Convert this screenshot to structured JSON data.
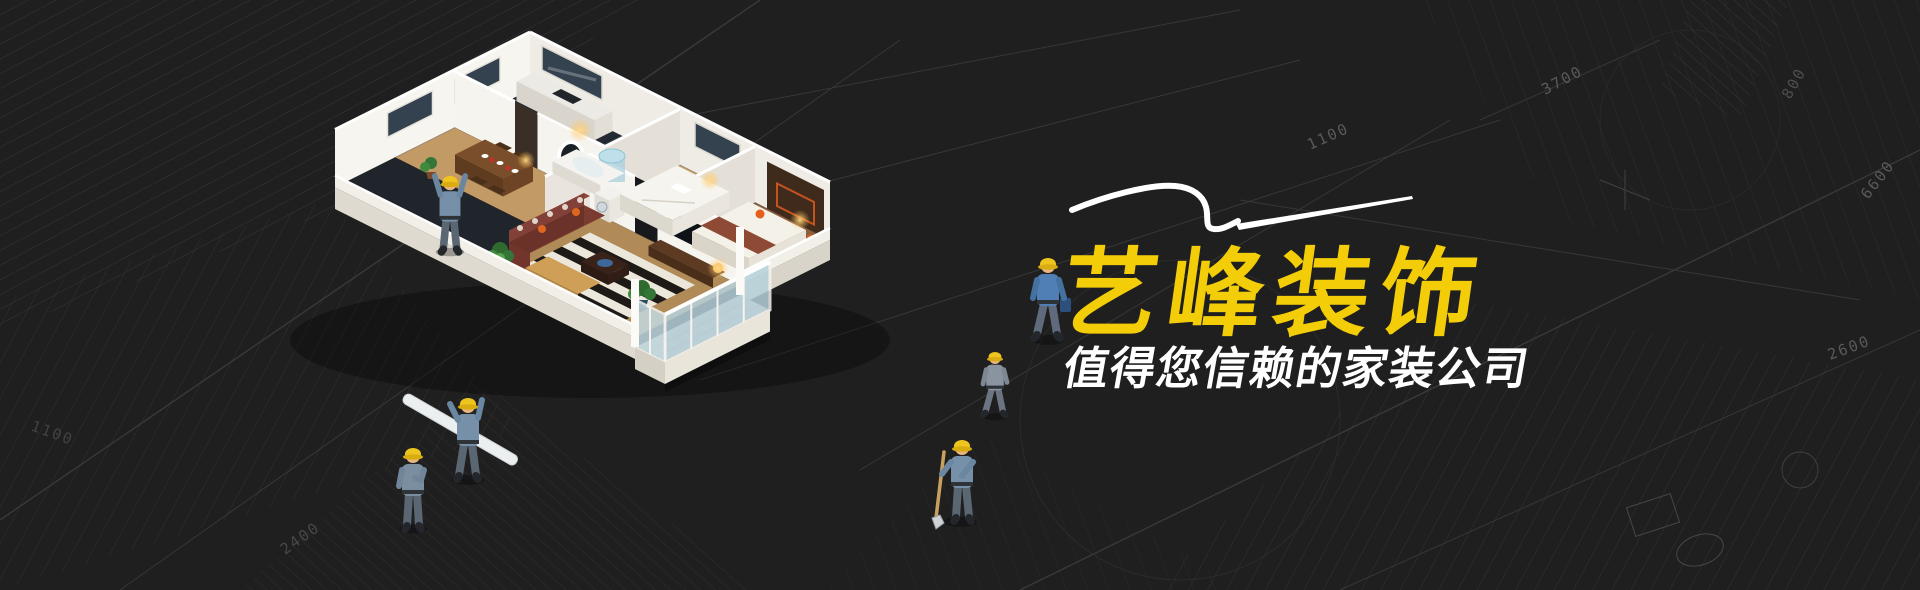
{
  "banner": {
    "company_name": "艺峰装饰",
    "tagline": "值得您信赖的家装公司",
    "colors": {
      "accent_yellow": "#F3CD08",
      "tagline_white": "#FFFFFF",
      "background": "#1F1F1F",
      "blueprint_line": "#3A3A3A"
    }
  },
  "blueprint": {
    "labels": [
      "3700",
      "1100",
      "6600",
      "2600",
      "2400",
      "800",
      "1100"
    ]
  },
  "scene": {
    "apartment": "isometric-apartment-cutaway-photo",
    "workers": [
      "worker-reaching-up",
      "worker-carrying-plank",
      "worker-standing",
      "worker-walking-gray",
      "worker-with-shovel",
      "worker-walking-blue"
    ],
    "swoosh": "white-pen-swoosh"
  }
}
